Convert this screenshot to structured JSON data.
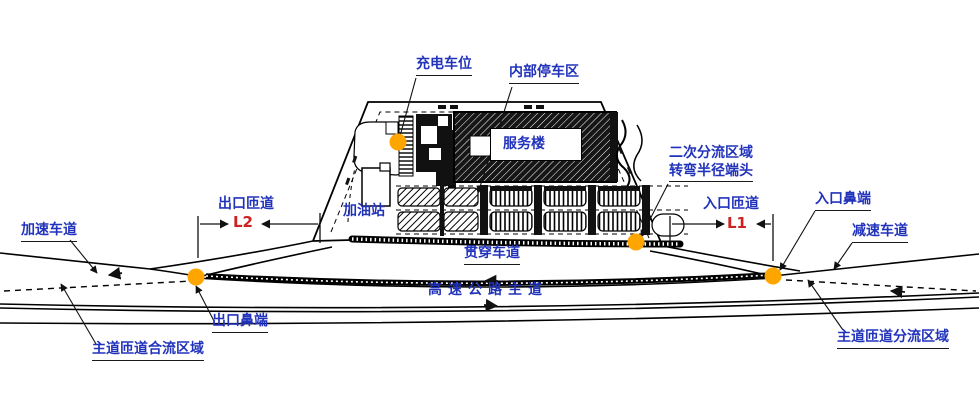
{
  "colors": {
    "label_blue": "#2233bb",
    "dimension_red": "#cc2222",
    "marker_orange": "#ffa500",
    "line_black": "#000000",
    "background": "#ffffff"
  },
  "labels": {
    "accel_lane": "加速车道",
    "exit_ramp": "出口匝道",
    "l2": "L2",
    "charging_spot": "充电车位",
    "internal_parking": "内部停车区",
    "service_building": "服务楼",
    "gas_station": "加油站",
    "secondary_diverge_1": "二次分流区域",
    "secondary_diverge_2": "转弯半径端头",
    "entrance_ramp": "入口匝道",
    "l1": "L1",
    "entrance_nose": "入口鼻端",
    "decel_lane": "减速车道",
    "through_lane": "贯穿车道",
    "highway_main": "高速公路主道",
    "exit_nose": "出口鼻端",
    "merge_area": "主道匝道合流区域",
    "diverge_area": "主道匝道分流区域"
  }
}
